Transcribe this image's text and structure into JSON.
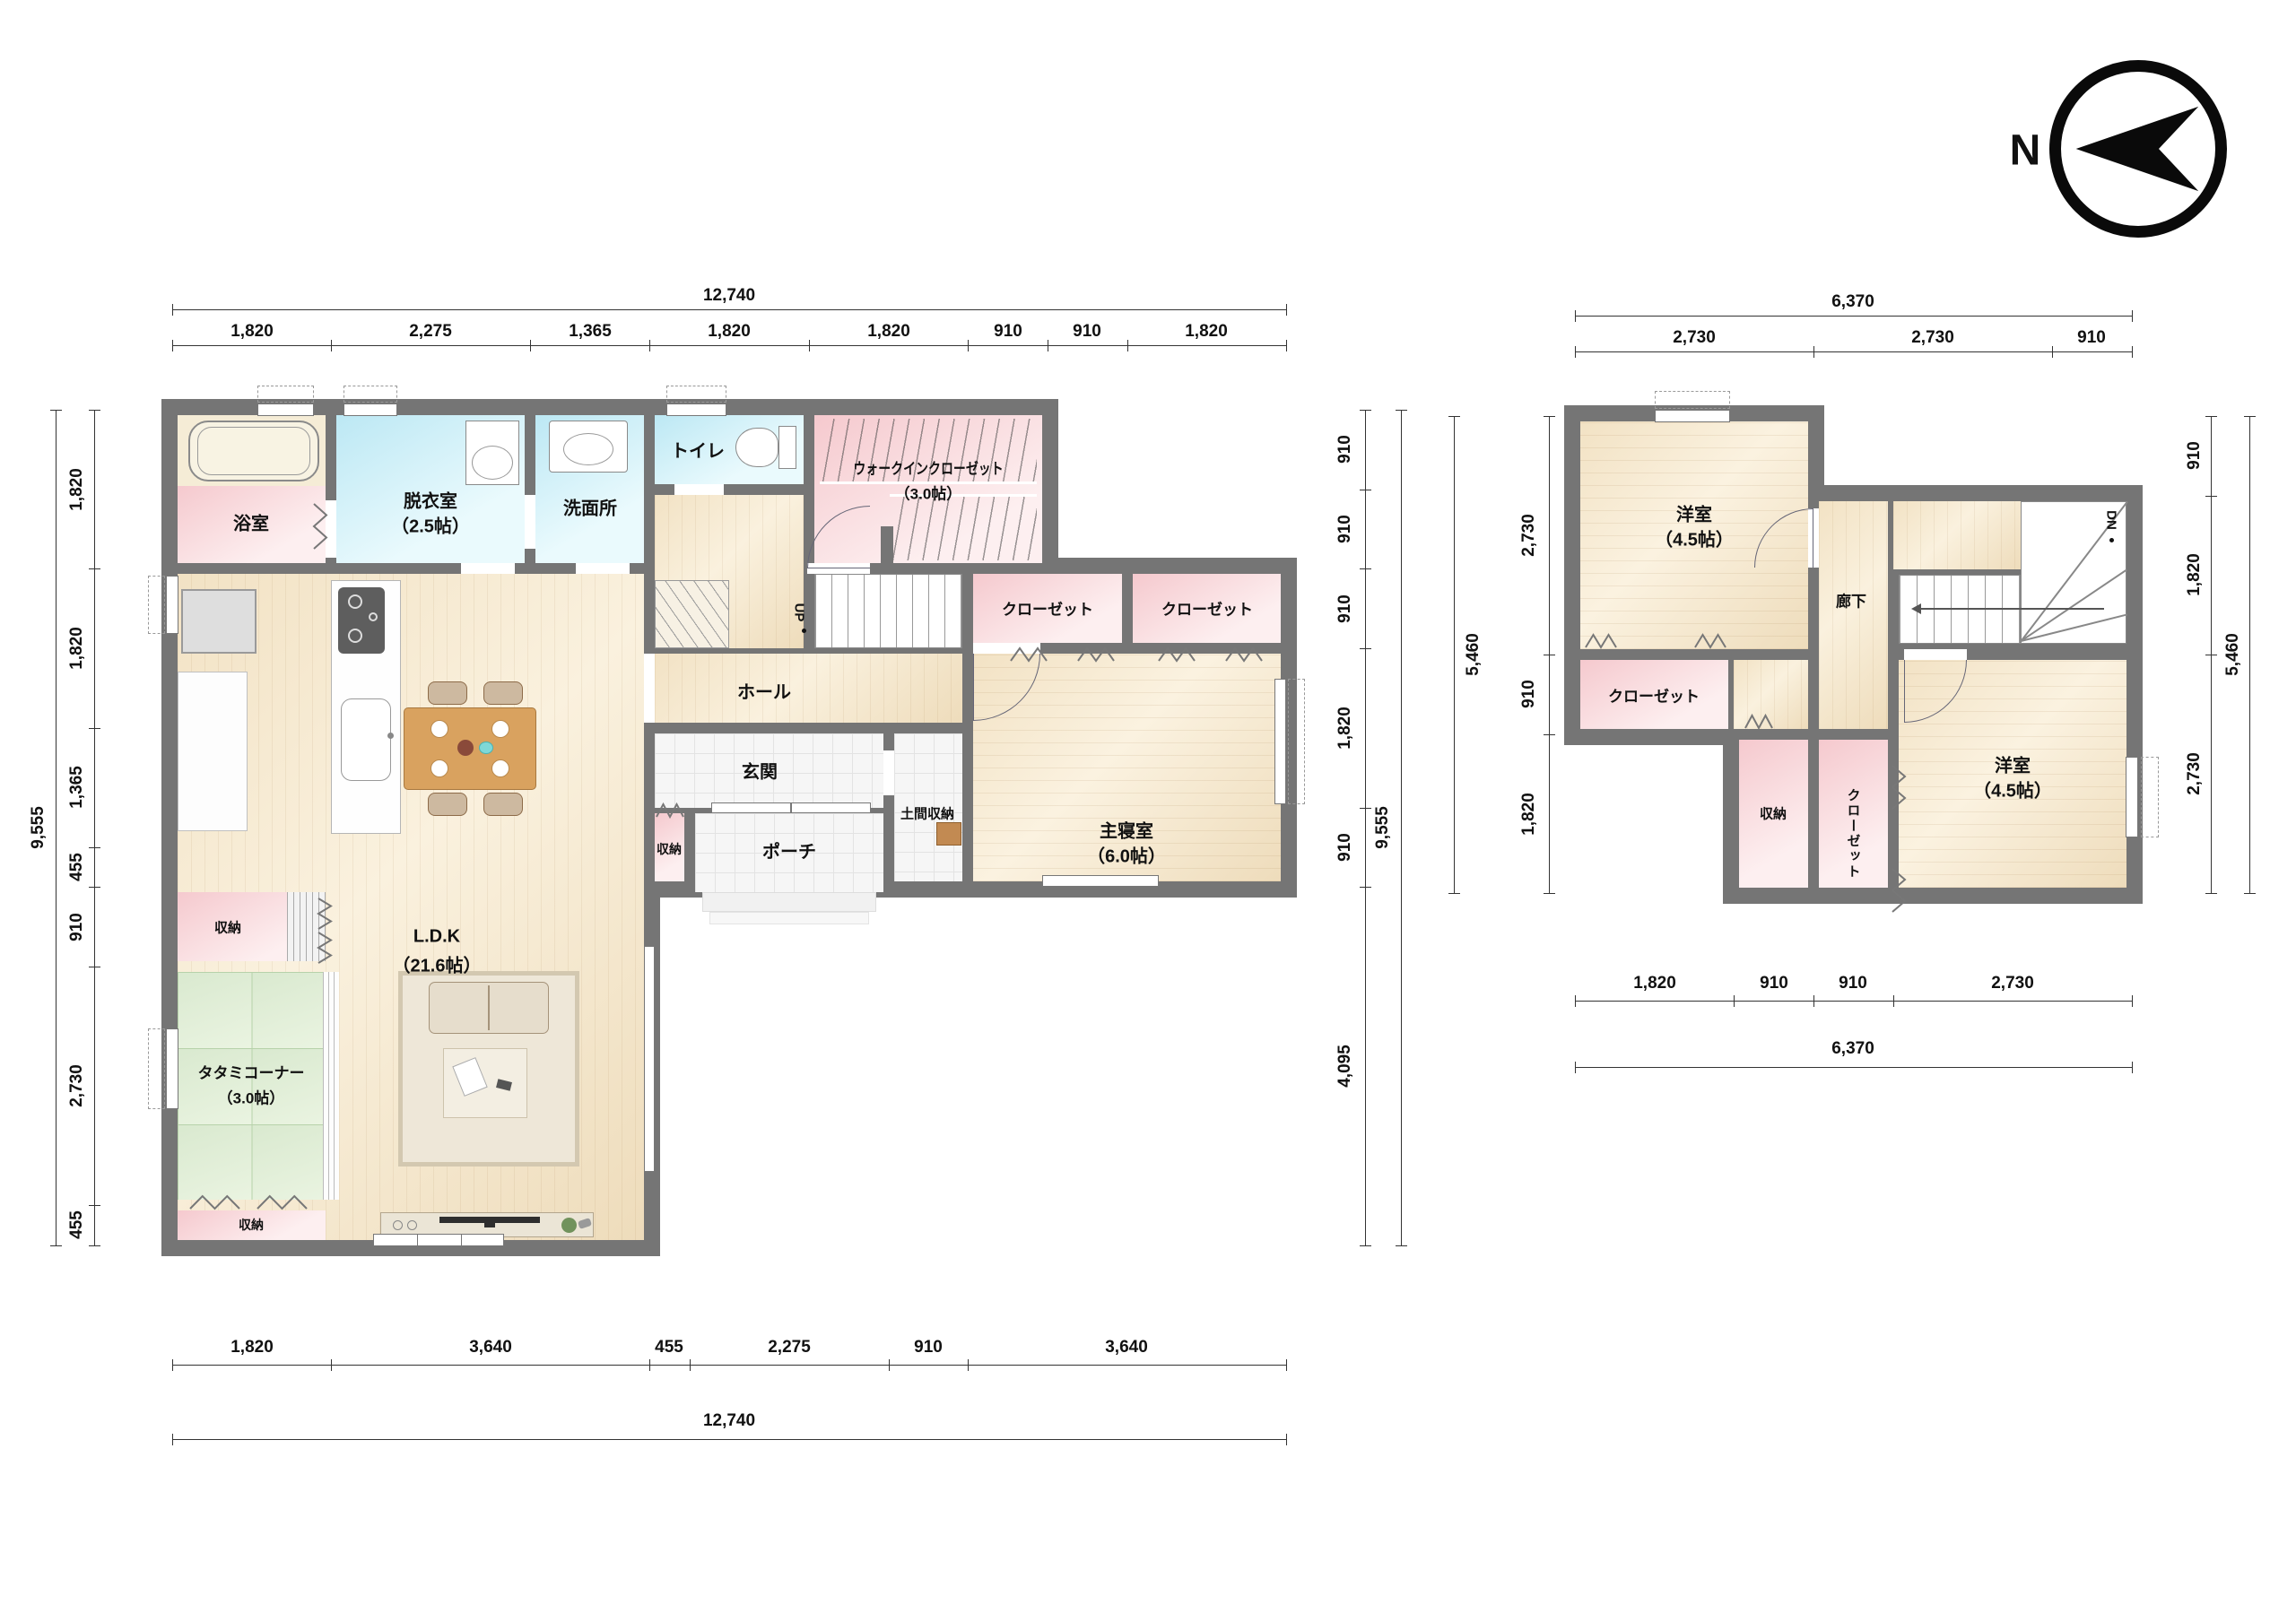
{
  "compass": {
    "north_label": "N"
  },
  "f1": {
    "rooms": {
      "bath": "浴室",
      "dressing": "脱衣室",
      "dressing_size": "（2.5帖）",
      "washroom": "洗面所",
      "toilet": "トイレ",
      "wic": "ウォークインクローゼット",
      "wic_size": "（3.0帖）",
      "hall": "ホール",
      "stairs_up": "UP",
      "entrance": "玄関",
      "doma_storage": "土間収納",
      "storage_entry": "収納",
      "porch": "ポーチ",
      "closet_a": "クローゼット",
      "closet_b": "クローゼット",
      "master": "主寝室",
      "master_size": "（6.0帖）",
      "ldk": "L.D.K",
      "ldk_size": "（21.6帖）",
      "storage_mid": "収納",
      "tatami": "タタミコーナー",
      "tatami_size": "（3.0帖）",
      "storage_bottom": "収納"
    },
    "dims": {
      "top_total": "12,740",
      "top": [
        "1,820",
        "2,275",
        "1,365",
        "1,820",
        "1,820",
        "910",
        "910",
        "1,820"
      ],
      "bottom": [
        "1,820",
        "3,640",
        "455",
        "2,275",
        "910",
        "3,640"
      ],
      "bottom_total": "12,740",
      "left": [
        "1,820",
        "1,820",
        "1,365",
        "455",
        "910",
        "2,730",
        "455"
      ],
      "left_total": "9,555",
      "right": [
        "910",
        "910",
        "910",
        "1,820",
        "910",
        "4,095"
      ],
      "right_total": "9,555"
    }
  },
  "f2": {
    "rooms": {
      "bedroom_a": "洋室",
      "bedroom_a_size": "（4.5帖）",
      "corridor": "廊下",
      "stairs_down": "DN",
      "closet_a": "クローゼット",
      "storage": "収納",
      "closet_b": "クローゼット",
      "bedroom_b": "洋室",
      "bedroom_b_size": "（4.5帖）"
    },
    "dims": {
      "top_total": "6,370",
      "top": [
        "2,730",
        "2,730",
        "910"
      ],
      "bottom": [
        "1,820",
        "910",
        "910",
        "2,730"
      ],
      "bottom_total": "6,370",
      "left": [
        "2,730",
        "910",
        "1,820"
      ],
      "left_total": "5,460",
      "right": [
        "910",
        "1,820",
        "2,730"
      ],
      "right_total": "5,460"
    }
  }
}
